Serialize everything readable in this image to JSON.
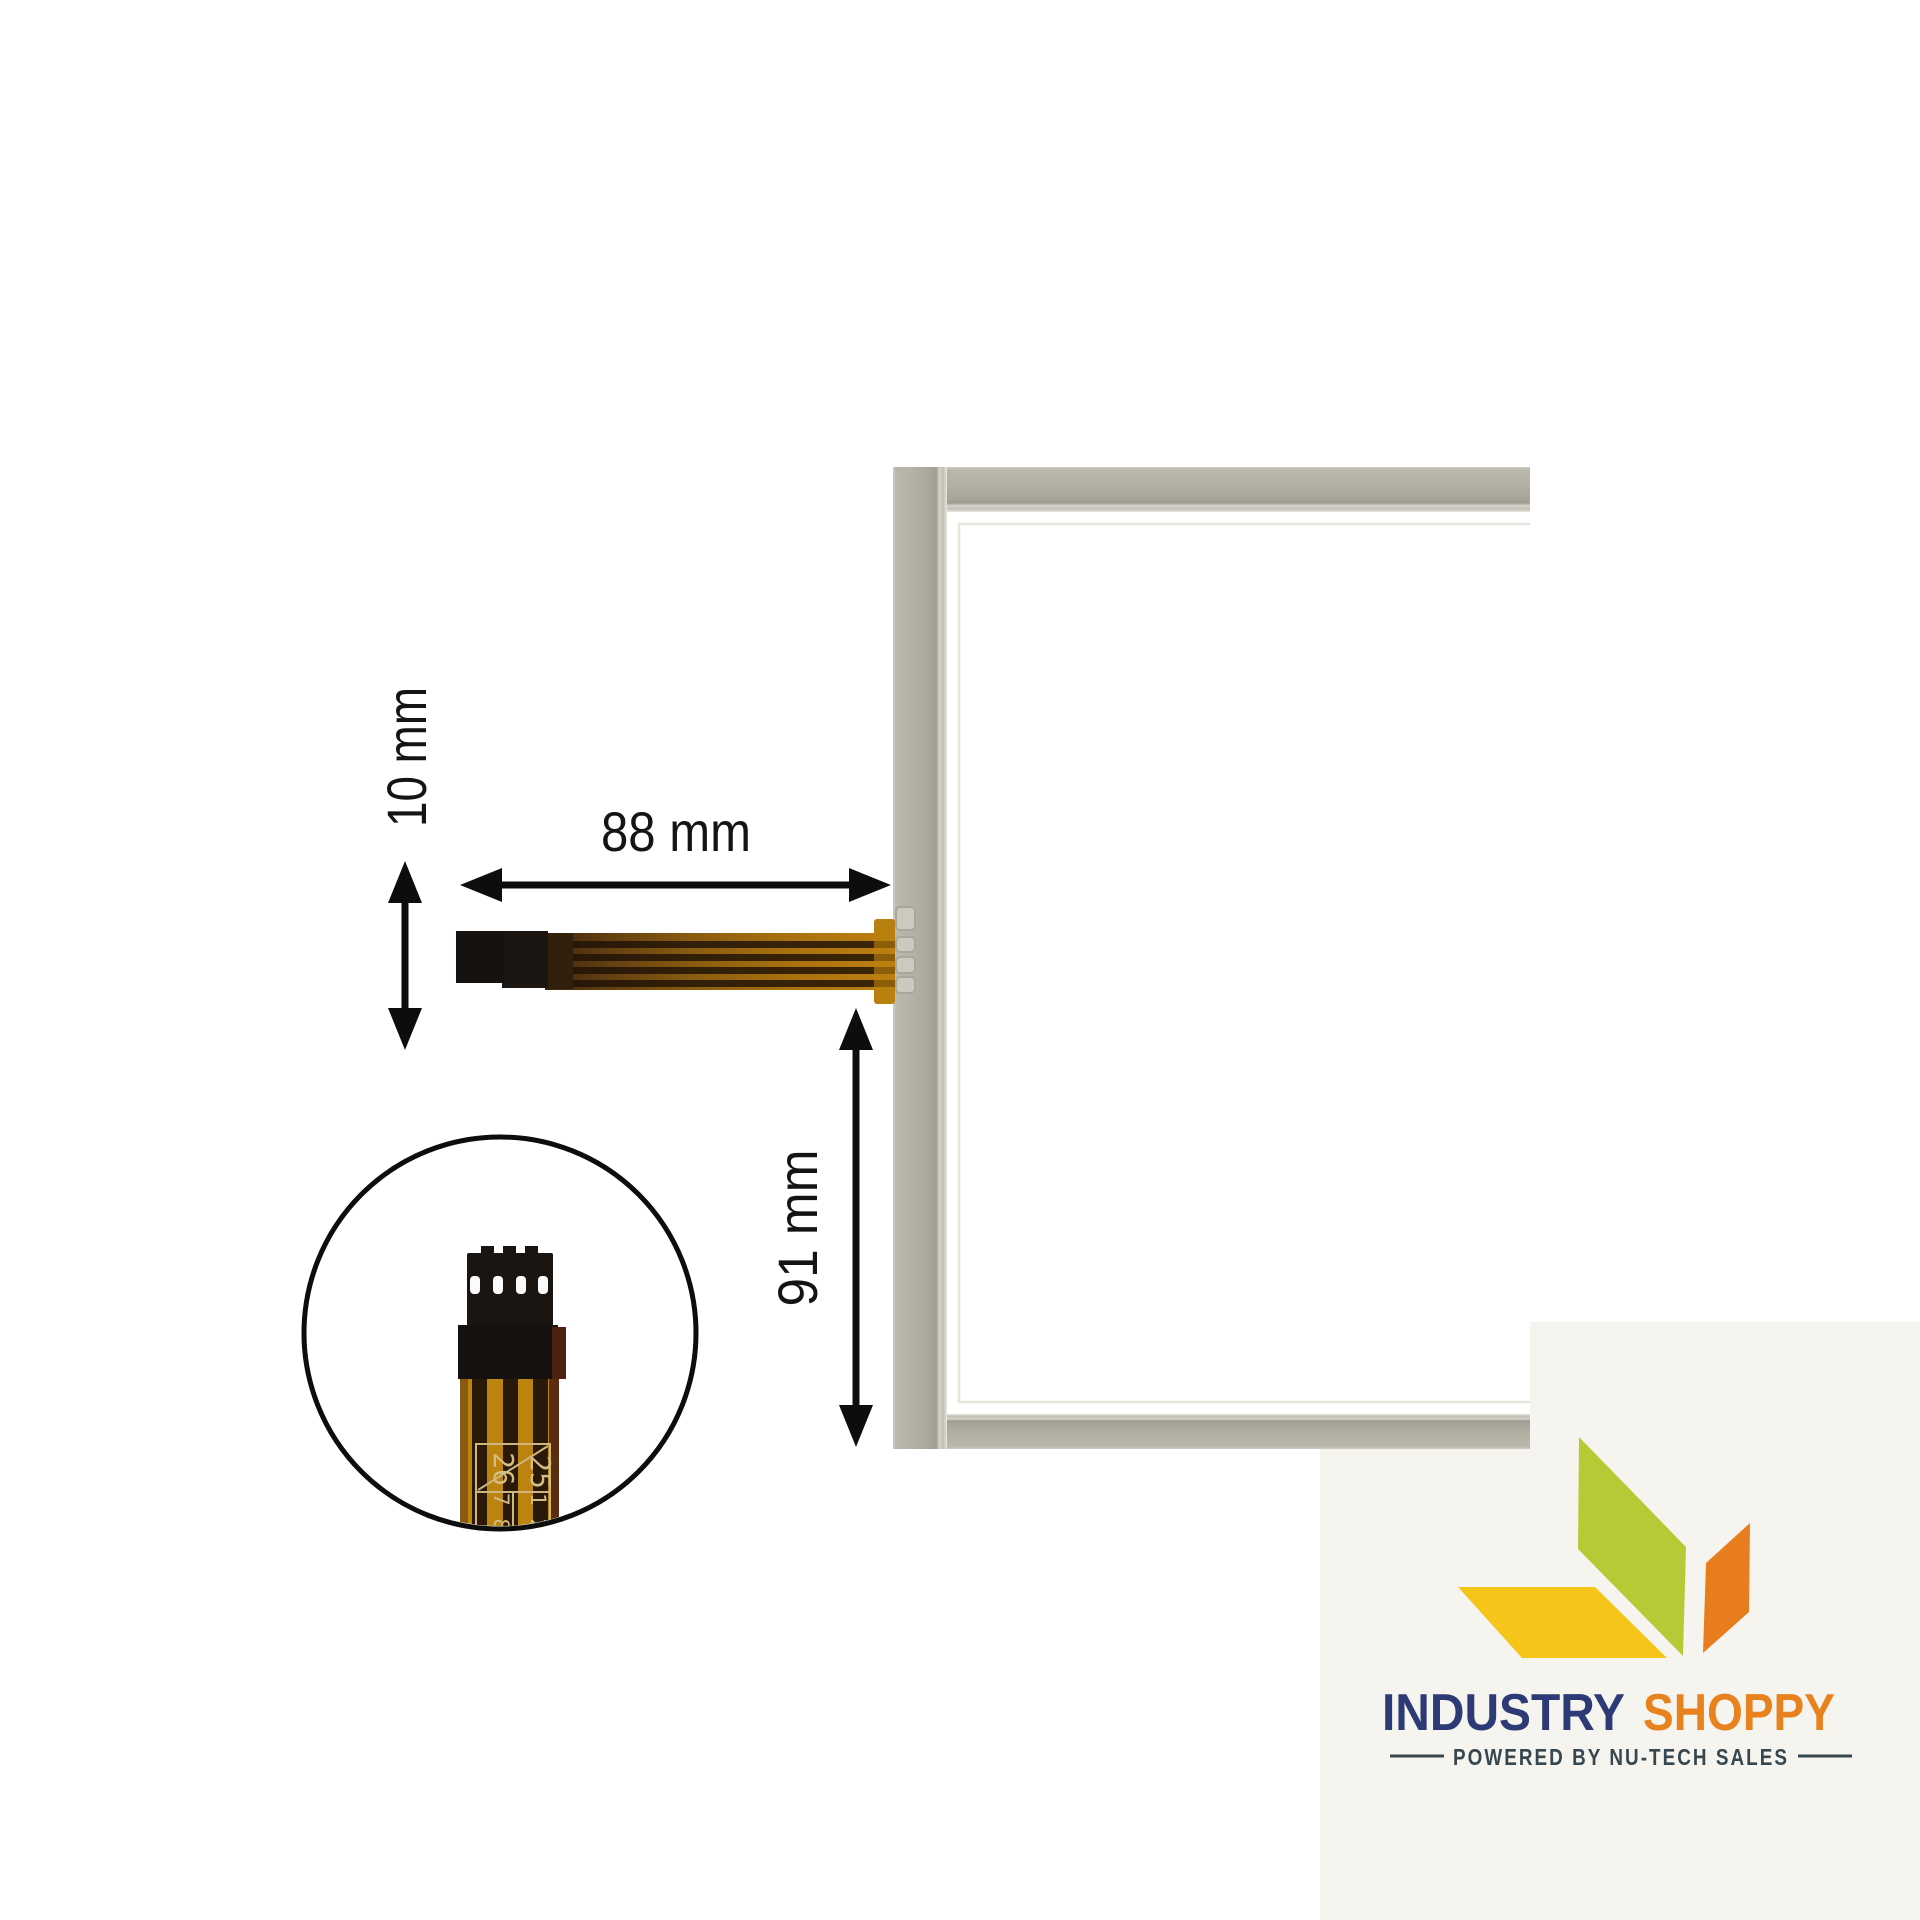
{
  "page": {
    "background_color": "#ffffff"
  },
  "annotations": {
    "cable_width": "10 mm",
    "cable_length": "88 mm",
    "tail_offset": "91 mm"
  },
  "inset_markings": {
    "top_left": "26",
    "top_right": "25",
    "bottom_left": "7 8",
    "bottom_right": "1 2"
  },
  "logo": {
    "brand_word1": "INDUSTRY",
    "brand_word2": "SHOPPY",
    "tagline": "POWERED BY NU-TECH SALES",
    "colors": {
      "word1": "#2c3a75",
      "word2": "#e8821e",
      "tagline": "#37474f",
      "diamond_green": "#b5ca35",
      "diamond_yellow": "#f6c51a",
      "diamond_orange": "#e87d1d",
      "background": "#f6f4ee"
    }
  },
  "product_colors": {
    "frame_gray": "#b3b0a4",
    "cable_orange": "#b4790f",
    "connector_black": "#1a1511",
    "arrow_black": "#0d0d0d"
  }
}
